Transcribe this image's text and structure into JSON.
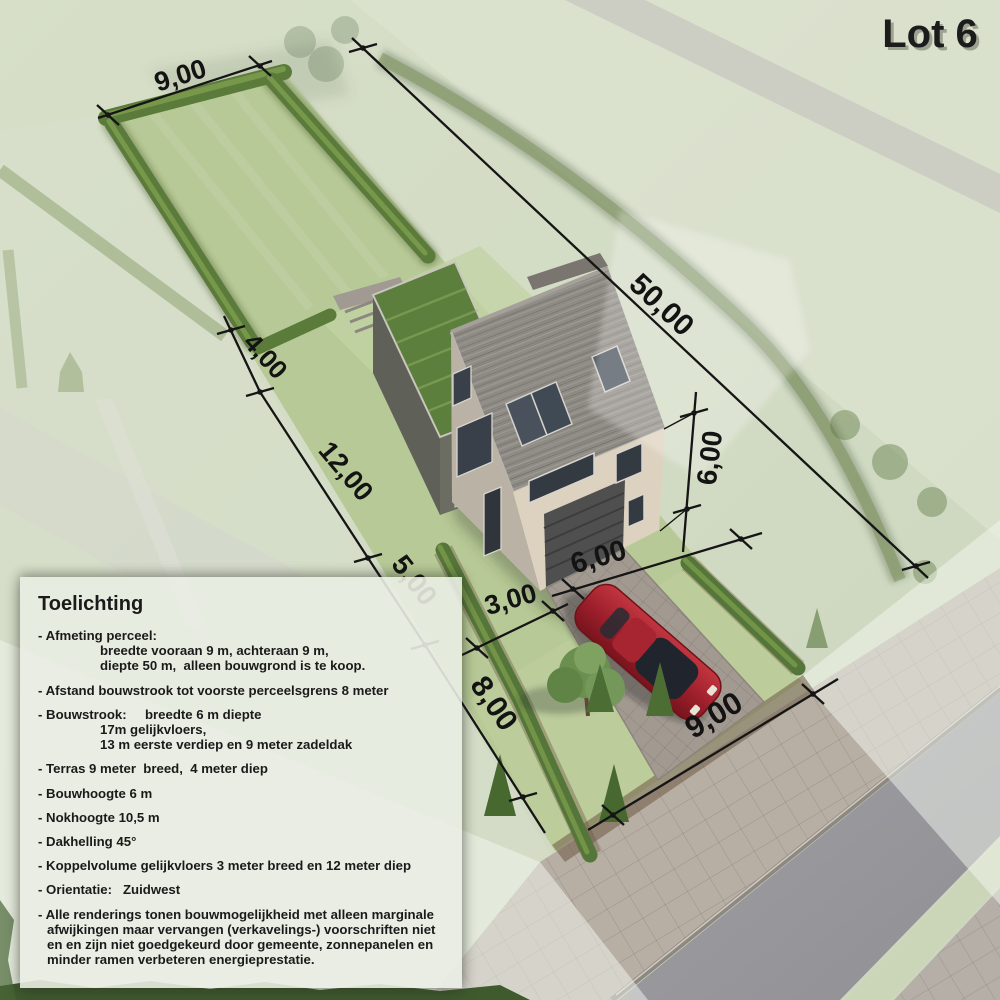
{
  "title": "Lot 6",
  "dims": {
    "garden_width": "9,00",
    "lot_depth": "50,00",
    "terrace_depth": "4,00",
    "annex_depth": "12,00",
    "mid_section": "5,00",
    "front_setback": "8,00",
    "building_height": "6,00",
    "house_width": "6,00",
    "annex_width": "3,00",
    "frontage": "9,00"
  },
  "legend": {
    "title": "Toelichting",
    "items": [
      {
        "lines": [
          "- Afmeting perceel:",
          "breedte vooraan 9 m, achteraan 9 m,",
          "diepte 50 m,  alleen bouwgrond is te koop."
        ]
      },
      {
        "lines": [
          "- Afstand bouwstrook tot voorste perceelsgrens 8 meter"
        ]
      },
      {
        "lines": [
          "- Bouwstrook:     breedte 6 m diepte",
          "17m gelijkvloers,",
          "13 m eerste verdiep en 9 meter zadeldak"
        ]
      },
      {
        "lines": [
          "- Terras 9 meter  breed,  4 meter diep"
        ]
      },
      {
        "lines": [
          "- Bouwhoogte 6 m"
        ]
      },
      {
        "lines": [
          "- Nokhoogte 10,5 m"
        ]
      },
      {
        "lines": [
          "- Dakhelling 45°"
        ]
      },
      {
        "lines": [
          "- Koppelvolume gelijkvloers 3 meter breed en 12 meter diep"
        ]
      },
      {
        "lines": [
          "- Orientatie:   Zuidwest"
        ]
      },
      {
        "lines": [
          "- Alle renderings tonen bouwmogelijkheid met alleen marginale afwijkingen maar vervangen (verkavelings-) voorschriften niet en en zijn niet goedgekeurd door gemeente, zonnepanelen en minder ramen verbeteren energieprestatie."
        ]
      }
    ]
  },
  "colors": {
    "lot_grass": "#b7c996",
    "hedge_green": "#5a7b39",
    "roof_gray": "#8e8a84",
    "brick_cream": "#ddd2bf",
    "green_roof": "#5d7f3e",
    "car_red": "#a32430",
    "asphalt": "#9a9a9f",
    "sidewalk": "#b7aea4",
    "dimension_ink": "#131313"
  }
}
